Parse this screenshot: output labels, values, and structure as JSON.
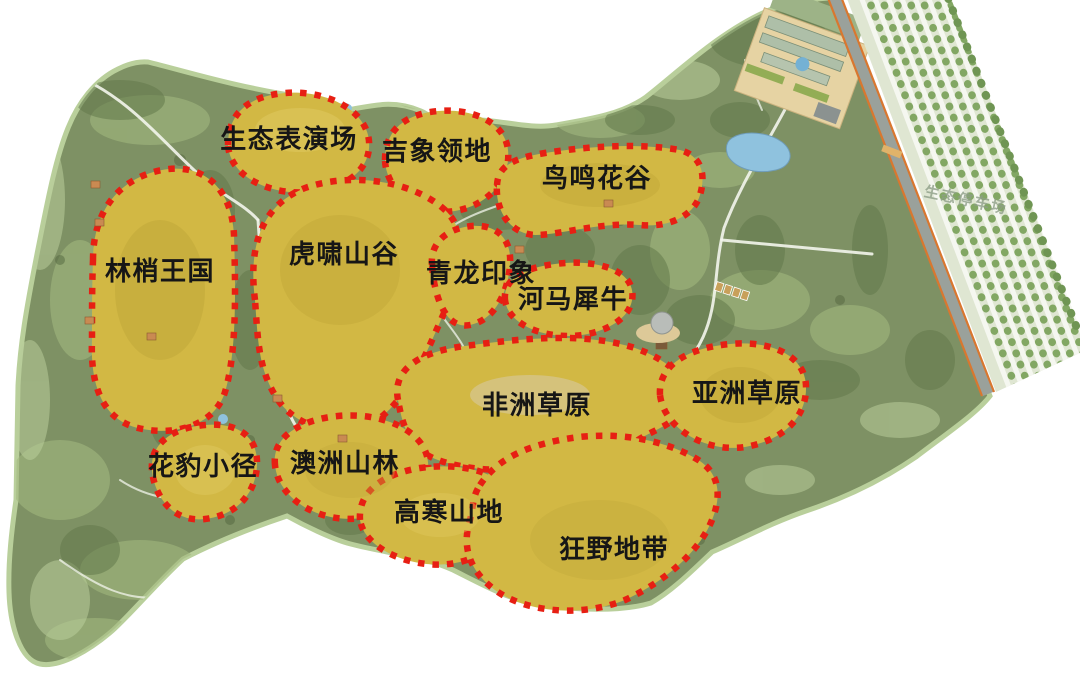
{
  "map_type": "zoo-master-plan-zoning-map",
  "zones": [
    {
      "id": "eco-performance",
      "label": "生态表演场"
    },
    {
      "id": "elephant-territory",
      "label": "吉象领地"
    },
    {
      "id": "birdsong-valley",
      "label": "鸟鸣花谷"
    },
    {
      "id": "treetop-kingdom",
      "label": "林梢王国"
    },
    {
      "id": "tiger-valley",
      "label": "虎啸山谷"
    },
    {
      "id": "dragon-impression",
      "label": "青龙印象"
    },
    {
      "id": "hippo-rhino",
      "label": "河马犀牛"
    },
    {
      "id": "african-savanna",
      "label": "非洲草原"
    },
    {
      "id": "asian-savanna",
      "label": "亚洲草原"
    },
    {
      "id": "leopard-trail",
      "label": "花豹小径"
    },
    {
      "id": "australian-forest",
      "label": "澳洲山林"
    },
    {
      "id": "alpine-highland",
      "label": "高寒山地"
    },
    {
      "id": "wild-zone",
      "label": "狂野地带"
    }
  ],
  "parking": {
    "label": "生态停车场"
  },
  "colors": {
    "park_green": "#7e9164",
    "light_green": "#a2b87e",
    "tree_dark": "#62794b",
    "zone_yellow": "#d2b844",
    "boundary_red": "#e71f13",
    "water_blue": "#8fc2de",
    "road_gray": "#9aa19b",
    "road_edge_orange": "#d9772f",
    "label_black": "#161616"
  }
}
